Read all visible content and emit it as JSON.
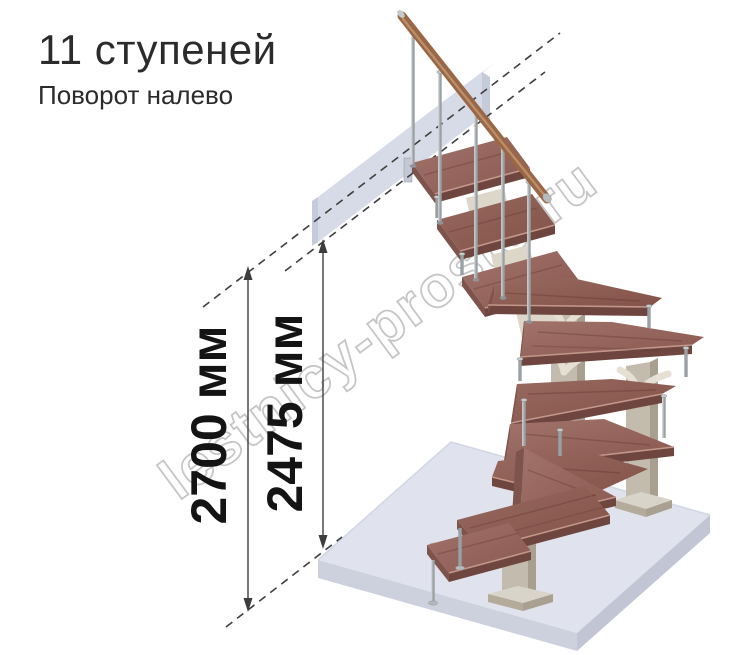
{
  "header": {
    "title": "11 ступеней",
    "subtitle": "Поворот налево"
  },
  "dimensions": [
    {
      "label": "2700 мм"
    },
    {
      "label": "2475 мм"
    }
  ],
  "watermark": {
    "text": "lestnicy-prosto.ru"
  },
  "diagram": {
    "steps_count": 11,
    "turn_direction": "left"
  },
  "colors": {
    "background": "#ffffff",
    "title_text": "#2b2b2b",
    "dimension_lines": "#3d3d3d",
    "tread_wood": "#96675f",
    "tread_front": "#6f463f",
    "handrail_wood": "#9a6746",
    "floor_slab": "#e0e3ed",
    "landing_beam": "#d7dbe8",
    "support_column": "#c3bcae",
    "bracket_cream": "#e6e0d4",
    "baluster_metal": "#a6acaf",
    "watermark_gray": "#c6c6c6"
  }
}
